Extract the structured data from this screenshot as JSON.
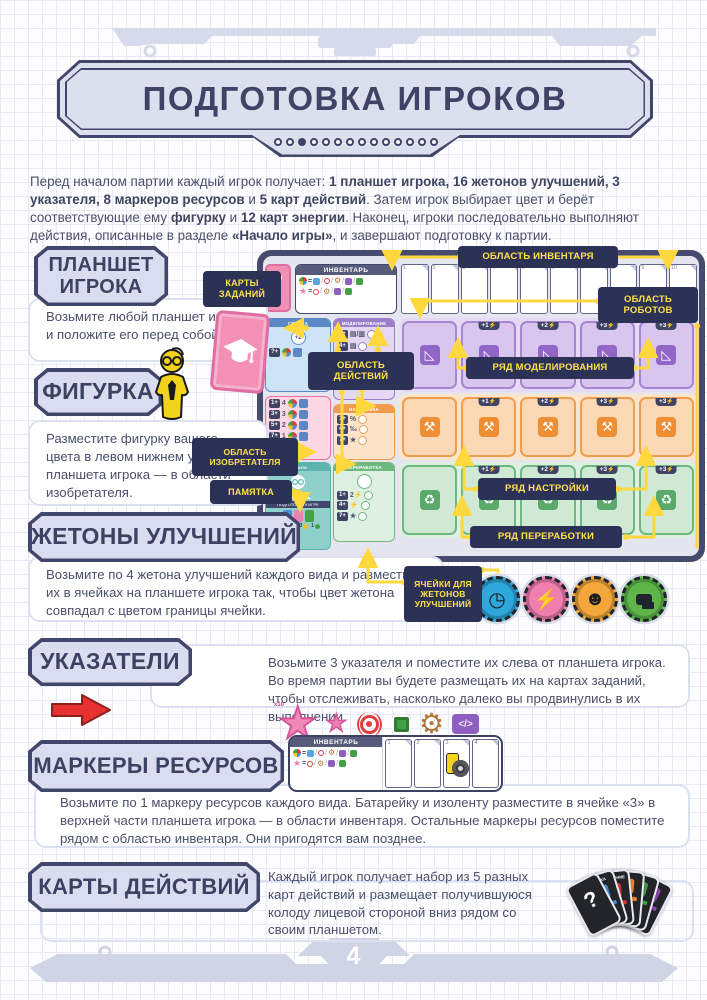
{
  "header": {
    "title": "ПОДГОТОВКА ИГРОКОВ",
    "dots": [
      {
        "on": false
      },
      {
        "on": false
      },
      {
        "on": true
      },
      {
        "on": false
      },
      {
        "on": false
      },
      {
        "on": false
      },
      {
        "on": false
      },
      {
        "on": false
      },
      {
        "on": false
      },
      {
        "on": false
      },
      {
        "on": false
      },
      {
        "on": false
      },
      {
        "on": false
      },
      {
        "on": false
      }
    ]
  },
  "intro_segments": [
    {
      "t": "Перед началом партии каждый игрок получает: "
    },
    {
      "t": "1 планшет игрока, 16 жетонов улучшений, 3 указателя, 8 маркеров ресурсов",
      "b": true
    },
    {
      "t": " и "
    },
    {
      "t": "5 карт действий",
      "b": true
    },
    {
      "t": ". Затем игрок выбирает цвет и берёт соответствующие ему "
    },
    {
      "t": "фигурку",
      "b": true
    },
    {
      "t": " и "
    },
    {
      "t": "12 карт энергии",
      "b": true
    },
    {
      "t": ". Наконец, игроки последовательно выполняют действия, описанные в разделе "
    },
    {
      "t": "«Начало игры»",
      "b": true
    },
    {
      "t": ", и завершают подготовку к партии."
    }
  ],
  "sections": {
    "player_board": {
      "title": "ПЛАНШЕТ ИГРОКА",
      "body": "Возьмите любой планшет игрока и положите его перед собой."
    },
    "figure": {
      "title": "ФИГУРКА",
      "body": "Разместите фигурку вашего цвета в левом нижнем углу планшета игрока — в области изобретателя."
    },
    "upgrade_tokens": {
      "title": "ЖЕТОНЫ УЛУЧШЕНИЙ",
      "body": "Возьмите по 4 жетона улучшений каждого вида и разместите их в ячейках на планшете игрока так, чтобы цвет жетона совпадал с цветом границы ячейки."
    },
    "pointers": {
      "title": "УКАЗАТЕЛИ",
      "body": "Возьмите 3 указателя и поместите их слева от планшета игрока. Во время партии вы будете размещать их на картах заданий, чтобы отслеживать, насколько далеко вы продвинулись в их выполнении."
    },
    "resource_markers": {
      "title": "МАРКЕРЫ РЕСУРСОВ",
      "body": "Возьмите по 1 маркеру ресурсов каждого вида. Батарейку и изоленту разместите в ячейке «3» в верхней части планшета игрока — в области инвентаря. Остальные маркеры ресурсов поместите рядом с областью инвентаря. Они пригодятся вам позднее."
    },
    "action_cards": {
      "title": "КАРТЫ ДЕЙСТВИЙ",
      "body": "Каждый игрок получает набор из 5 разных карт действий и размещает получившуюся колоду лицевой стороной вниз рядом со своим планшетом."
    }
  },
  "board": {
    "callouts": {
      "inventory_area": "ОБЛАСТЬ ИНВЕНТАРЯ",
      "task_cards": "КАРТЫ ЗАДАНИЙ",
      "robots_area": "ОБЛАСТЬ РОБОТОВ",
      "actions_area": "ОБЛАСТЬ ДЕЙСТВИЙ",
      "modeling_row": "РЯД МОДЕЛИРОВАНИЯ",
      "inventor_area": "ОБЛАСТЬ ИЗОБРЕТАТЕЛЯ",
      "memo": "ПАМЯТКА",
      "tuning_row": "РЯД НАСТРОЙКИ",
      "recycling_row": "РЯД ПЕРЕРАБОТКИ",
      "upgrade_cells": "ЯЧЕЙКИ ДЛЯ ЖЕТОНОВ УЛУЧШЕНИЙ"
    },
    "inventory_label": "ИНВЕНТАРЬ",
    "inventory_cells": [
      {
        "n": "1"
      },
      {
        "n": "2"
      },
      {
        "n": "3"
      },
      {
        "n": "4"
      },
      {
        "n": "5"
      },
      {
        "n": "6"
      },
      {
        "n": "7"
      },
      {
        "n": "8"
      },
      {
        "n": "9"
      },
      {
        "n": "10"
      }
    ],
    "formula_full": [
      {
        "ic": "pie"
      },
      {
        "ic": "eq"
      },
      {
        "ic": "blue"
      },
      {
        "ic": "sl"
      },
      {
        "ic": "coil-s"
      },
      {
        "ic": "sl"
      },
      {
        "ic": "gear-s"
      },
      {
        "ic": "sl"
      },
      {
        "ic": "code-s"
      },
      {
        "ic": "sl"
      },
      {
        "ic": "chip-s"
      }
    ],
    "formula_star": [
      {
        "ic": "star-s"
      },
      {
        "ic": "eq"
      },
      {
        "ic": "coil-s"
      },
      {
        "ic": "sl"
      },
      {
        "ic": "gear-s"
      },
      {
        "ic": "sl"
      },
      {
        "ic": "code-s"
      },
      {
        "ic": "sl"
      },
      {
        "ic": "chip-s"
      }
    ],
    "panels": {
      "assembly": "СБОРКА",
      "modeling": "МОДЕЛИРОВАНИЕ",
      "tuning": "НАСТРОЙКА",
      "recycling": "ПЕРЕРАБОТКА"
    },
    "assembly_req": "?+",
    "assembly_badge": "+2",
    "pink_rows": [
      {
        "req": "1+",
        "v": "4"
      },
      {
        "req": "3+",
        "v": "3"
      },
      {
        "req": "5+",
        "v": "2"
      },
      {
        "req": "7+",
        "v": "1"
      }
    ],
    "modeling_rows": [
      {
        "req": "1+",
        "g": "▤/▥"
      },
      {
        "req": "4+",
        "g": "▤"
      },
      {
        "req": "7+",
        "g": "★"
      }
    ],
    "tuning_rows": [
      {
        "req": "1+",
        "g": "%"
      },
      {
        "req": "4+",
        "g": "‰"
      },
      {
        "req": "7+",
        "g": "★"
      }
    ],
    "recycling_rows": [
      {
        "req": "1+",
        "g": "2⚡"
      },
      {
        "req": "4+",
        "g": "⚡"
      },
      {
        "req": "7+",
        "g": "★"
      }
    ],
    "inventor": {
      "top": "НАЧАЛО",
      "bottom": "ПОДГОТОВКА К ИГРЕ"
    },
    "memo_chips": [
      {
        "v": "2",
        "color": "#4a90d9"
      },
      {
        "v": "1",
        "color": "#e53935"
      },
      {
        "v": "3",
        "color": "#f0c030"
      },
      {
        "v": "1",
        "color": "#43a047"
      }
    ],
    "rows_modeling": [
      {
        "label": ""
      },
      {
        "label": "+1"
      },
      {
        "label": "+2"
      },
      {
        "label": "+3"
      },
      {
        "label": "+3"
      }
    ],
    "rows_tuning": [
      {
        "label": ""
      },
      {
        "label": "+1"
      },
      {
        "label": "+2"
      },
      {
        "label": "+3"
      },
      {
        "label": "+3"
      }
    ],
    "rows_recycling": [
      {
        "label": ""
      },
      {
        "label": "+1"
      },
      {
        "label": "+2"
      },
      {
        "label": "+3"
      },
      {
        "label": "+3"
      }
    ],
    "tokens": [
      {
        "name": "upgrade-token-time",
        "color": "#2ea7db",
        "icon": "clock"
      },
      {
        "name": "upgrade-token-pig",
        "color": "#f07fae",
        "icon": "bolt"
      },
      {
        "name": "upgrade-token-dog",
        "color": "#f3a73a",
        "icon": "dog"
      },
      {
        "name": "upgrade-token-chat",
        "color": "#5eb648",
        "icon": "chat"
      }
    ]
  },
  "resource_icons": [
    {
      "name": "star-x10-marker",
      "icon": "star-big",
      "badge": "x10"
    },
    {
      "name": "star-marker",
      "icon": "star"
    },
    {
      "name": "coil-marker",
      "icon": "coil"
    },
    {
      "name": "chip-marker",
      "icon": "chip"
    },
    {
      "name": "gear-marker",
      "icon": "gear"
    },
    {
      "name": "code-marker",
      "icon": "code"
    }
  ],
  "markers_strip": {
    "label": "ИНВЕНТАРЬ",
    "cells": [
      {
        "n": "1"
      },
      {
        "n": "2"
      },
      {
        "n": "3",
        "items": [
          "battery",
          "tape"
        ]
      },
      {
        "n": "4"
      }
    ]
  },
  "action_cards": [
    {
      "name": "action-card-purple",
      "label": "",
      "color": "#8e44ad"
    },
    {
      "name": "action-card-green",
      "label": "",
      "color": "#43a047"
    },
    {
      "name": "action-card-orange",
      "label": "",
      "color": "#f5881f"
    },
    {
      "name": "action-card-upgrade",
      "label": "УЛУЧШЕНИЕ",
      "color": "#e53935"
    },
    {
      "name": "action-card-assembly",
      "label": "СБОРКА",
      "color": "#4a90d9"
    },
    {
      "name": "action-card-back",
      "label": "?",
      "color": "#23252b",
      "icon": "back"
    }
  ],
  "footer": {
    "page_number": "4"
  }
}
